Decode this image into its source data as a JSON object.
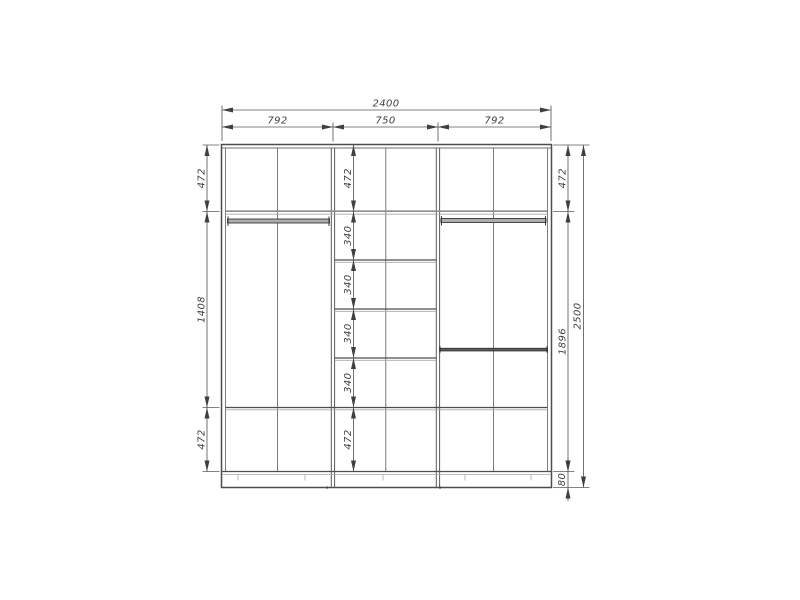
{
  "dims": {
    "overall_width": "2400",
    "sections": [
      "792",
      "750",
      "792"
    ],
    "left_chain": [
      "472",
      "1408",
      "472"
    ],
    "center_chain": [
      "472",
      "340",
      "340",
      "340",
      "340",
      "472"
    ],
    "right_chain": [
      "472",
      "1896",
      "80"
    ],
    "overall_height": "2500"
  },
  "colors": {
    "structure_line": "#4d4d4d",
    "dimension_line": "#5a5a5a",
    "dimension_text": "#3f3f3f",
    "rod_fill": "#adadad",
    "background": "#ffffff"
  }
}
